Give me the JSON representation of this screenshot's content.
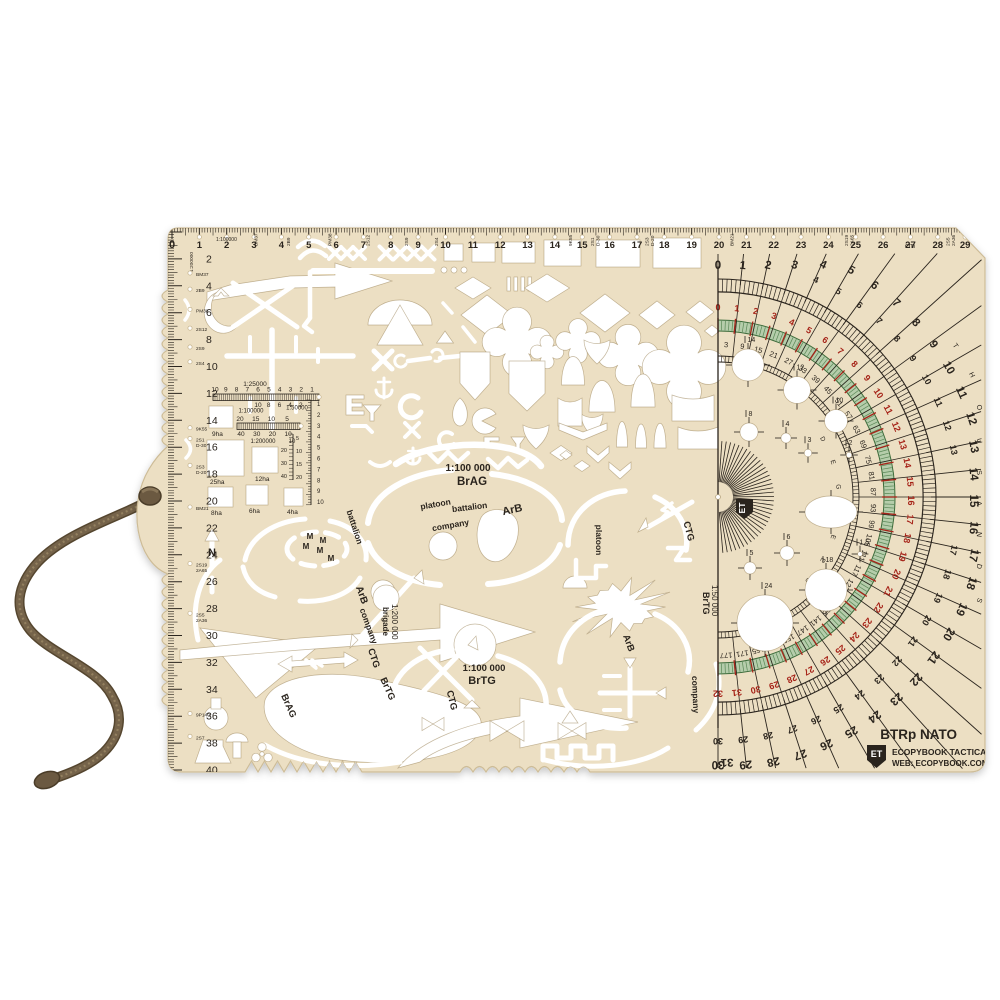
{
  "brand": {
    "model": "BTRp NATO",
    "company": "ECOPYBOOK TACTICAL",
    "web": "WEB: ECOPYBOOK.COM.UA",
    "logo": "ET"
  },
  "colors": {
    "plastic_beige": "#ecdfc3",
    "plastic_edge": "#cdbc97",
    "print_ink": "#2a241d",
    "print_red": "#a62318",
    "green_band": "#b5cdab",
    "green_line": "#5a8756",
    "cutout_white": "#ffffff",
    "cord_brown": "#75634a"
  },
  "top_ruler": {
    "scale_label": "1:100000",
    "unit_label": "cm",
    "min": 0,
    "max": 29
  },
  "left_ruler": {
    "scale_label": "1:200000",
    "min": 0,
    "max": 40
  },
  "artillery_marks": [
    {
      "label": "BM37",
      "km": 3.05
    },
    {
      "label": "2B9",
      "km": 4.25
    },
    {
      "label": "PM38",
      "km": 5.75
    },
    {
      "label": "2S12",
      "km": 7.15
    },
    {
      "label": "2S9",
      "km": 8.55
    },
    {
      "label": "2S4",
      "km": 9.65
    },
    {
      "label": "9K55",
      "km": 14.55
    },
    {
      "label": "2S1 D-30",
      "km": 15.35
    },
    {
      "label": "2S3 D-20",
      "km": 17.35
    },
    {
      "label": "BM21",
      "km": 20.45
    },
    {
      "label": "2S19 2A65",
      "km": 24.65
    },
    {
      "label": "2S5 2A36",
      "km": 28.35
    },
    {
      "label": "9P140",
      "km": 35.8
    },
    {
      "label": "2S7",
      "km": 37.5
    }
  ],
  "scale_block": {
    "r25": {
      "label": "1:25000",
      "ticks": [
        "10",
        "9",
        "8",
        "7",
        "6",
        "5",
        "4",
        "3",
        "2",
        "1"
      ]
    },
    "r50": {
      "label": "1:50000",
      "ticks": [
        "10",
        "8",
        "6",
        "4",
        "2"
      ]
    },
    "r100": {
      "label": "1:100000",
      "ticks": [
        "20",
        "15",
        "10",
        "5"
      ]
    },
    "r200": {
      "label": "1:200000",
      "ticks": [
        "40",
        "30",
        "20",
        "10"
      ],
      "extra": "10"
    },
    "vertical_a": [
      "1",
      "2",
      "3",
      "4",
      "5",
      "6",
      "7",
      "8",
      "9",
      "10"
    ],
    "vertical_b_left": [
      "20",
      "30",
      "40"
    ],
    "vertical_b_right": [
      "5",
      "10",
      "15",
      "20"
    ],
    "squares": [
      "9ha",
      "25ha",
      "12ha",
      "8ha",
      "6ha",
      "4ha"
    ]
  },
  "protractor": {
    "mils_scale": {
      "min": 0,
      "max": 30,
      "word": "THOUSANDS"
    },
    "nato_scale": {
      "min": 0,
      "max": 32
    },
    "degree_scale": {
      "min": 3,
      "max": 177,
      "step": 6,
      "word": "DEGREES"
    },
    "circle_labels": [
      "14",
      "12",
      "10",
      "8",
      "4",
      "3",
      "2",
      "1,5",
      "6",
      "5",
      "18",
      "24"
    ],
    "scale_label": "1:50 000",
    "scale_sub": "BrTG",
    "logo": "ET"
  },
  "unit_labels": {
    "platoon": "platoon",
    "battalion": "battalion",
    "company": "company",
    "arb": "ArB",
    "ctg": "CTG",
    "brag": "BrAG",
    "brtg": "BrTG",
    "brigade": "brigade",
    "north": "N",
    "mine": "M"
  },
  "scale_titles": {
    "s100": "1:100 000",
    "s200": "1:200 000",
    "s50": "1:50 000"
  },
  "stencil_symbols": [
    "block-arrow",
    "x-marks",
    "unit-rectangles",
    "diamonds",
    "quatrefoil",
    "shield",
    "pennant",
    "arch",
    "teardrop",
    "anchor",
    "wrench",
    "zigzag",
    "bowtie",
    "minefield-M",
    "north-arrow",
    "mushroom-cloud",
    "flask",
    "radiation-trefoil",
    "greek-meander",
    "artillery-cross",
    "oval-position-arcs",
    "attack-arrows",
    "circle-templates"
  ]
}
